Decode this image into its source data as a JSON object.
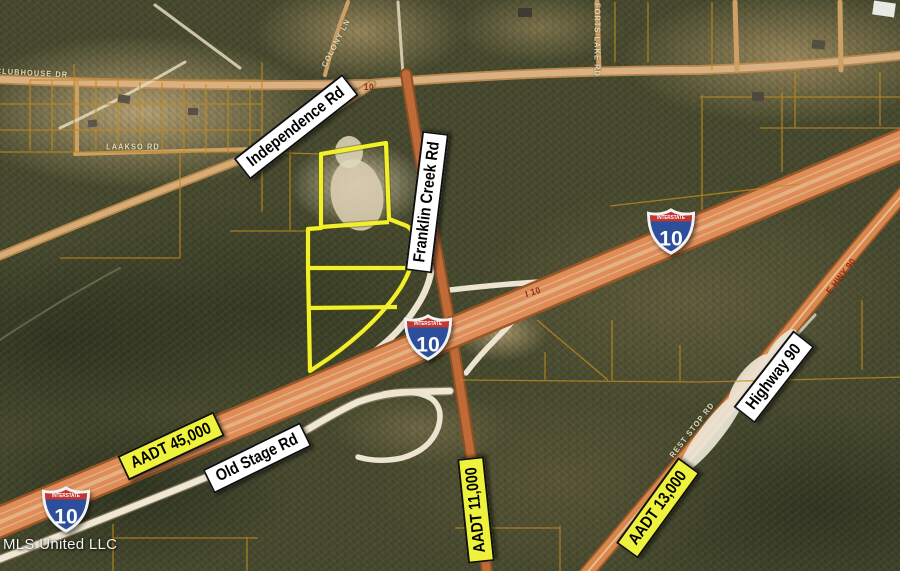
{
  "map": {
    "watermark": "MLS United LLC",
    "shield_text": {
      "top": "INTERSTATE",
      "number": "10"
    },
    "shields": [
      {
        "id": "i10-center",
        "x": 428,
        "y": 337
      },
      {
        "id": "i10-northeast",
        "x": 671,
        "y": 231
      },
      {
        "id": "i10-southwest",
        "x": 66,
        "y": 509
      }
    ],
    "road_banners": [
      {
        "id": "independence-rd",
        "label": "Independence Rd",
        "x": 296,
        "y": 127,
        "rot": -38
      },
      {
        "id": "franklin-creek-rd",
        "label": "Franklin Creek Rd",
        "x": 427,
        "y": 202,
        "rot": -83
      },
      {
        "id": "old-stage-rd",
        "label": "Old Stage Rd",
        "x": 257,
        "y": 458,
        "rot": -26
      },
      {
        "id": "highway-90",
        "label": "Highway 90",
        "x": 774,
        "y": 377,
        "rot": -52
      }
    ],
    "aadt_banners": [
      {
        "id": "aadt-45000",
        "label": "AADT 45,000",
        "x": 171,
        "y": 446,
        "rot": -25
      },
      {
        "id": "aadt-11000",
        "label": "AADT 11,000",
        "x": 476,
        "y": 510,
        "rot": -96
      },
      {
        "id": "aadt-13000",
        "label": "AADT 13,000",
        "x": 658,
        "y": 508,
        "rot": -54
      }
    ],
    "small_labels": [
      {
        "id": "clubhouse-dr",
        "text": "CLUBHOUSE DR",
        "x": 32,
        "y": 73,
        "rot": 3,
        "color": "light"
      },
      {
        "id": "laakso-rd",
        "text": "LAAKSO RD",
        "x": 133,
        "y": 147,
        "rot": 0,
        "color": "light"
      },
      {
        "id": "colony-ln",
        "text": "COLONY LN",
        "x": 336,
        "y": 43,
        "rot": -63,
        "color": "light"
      },
      {
        "id": "forts-lake-rd",
        "text": "FORTS LAKE RD",
        "x": 597,
        "y": 40,
        "rot": 90,
        "color": "light"
      },
      {
        "id": "rest-stop-rd",
        "text": "REST STOP RD",
        "x": 692,
        "y": 430,
        "rot": -52,
        "color": "light"
      },
      {
        "id": "e-hwy-90",
        "text": "E HWY 90",
        "x": 841,
        "y": 276,
        "rot": -52,
        "color": "dark-red"
      },
      {
        "id": "i-10-pavement",
        "text": "I 10",
        "x": 533,
        "y": 292,
        "rot": -17,
        "color": "dark-red"
      },
      {
        "id": "route-10-pavement",
        "text": "10",
        "x": 369,
        "y": 87,
        "rot": 0,
        "color": "dark-red"
      }
    ],
    "colors": {
      "banner_yellow": "#eef23d",
      "parcel_yellow": "#f2ef2d",
      "shield_blue": "#2c4e9b",
      "shield_red": "#c3372f",
      "interstate_orange": "#de8c58",
      "parcel_line_amber": "#bf8a1e"
    }
  }
}
